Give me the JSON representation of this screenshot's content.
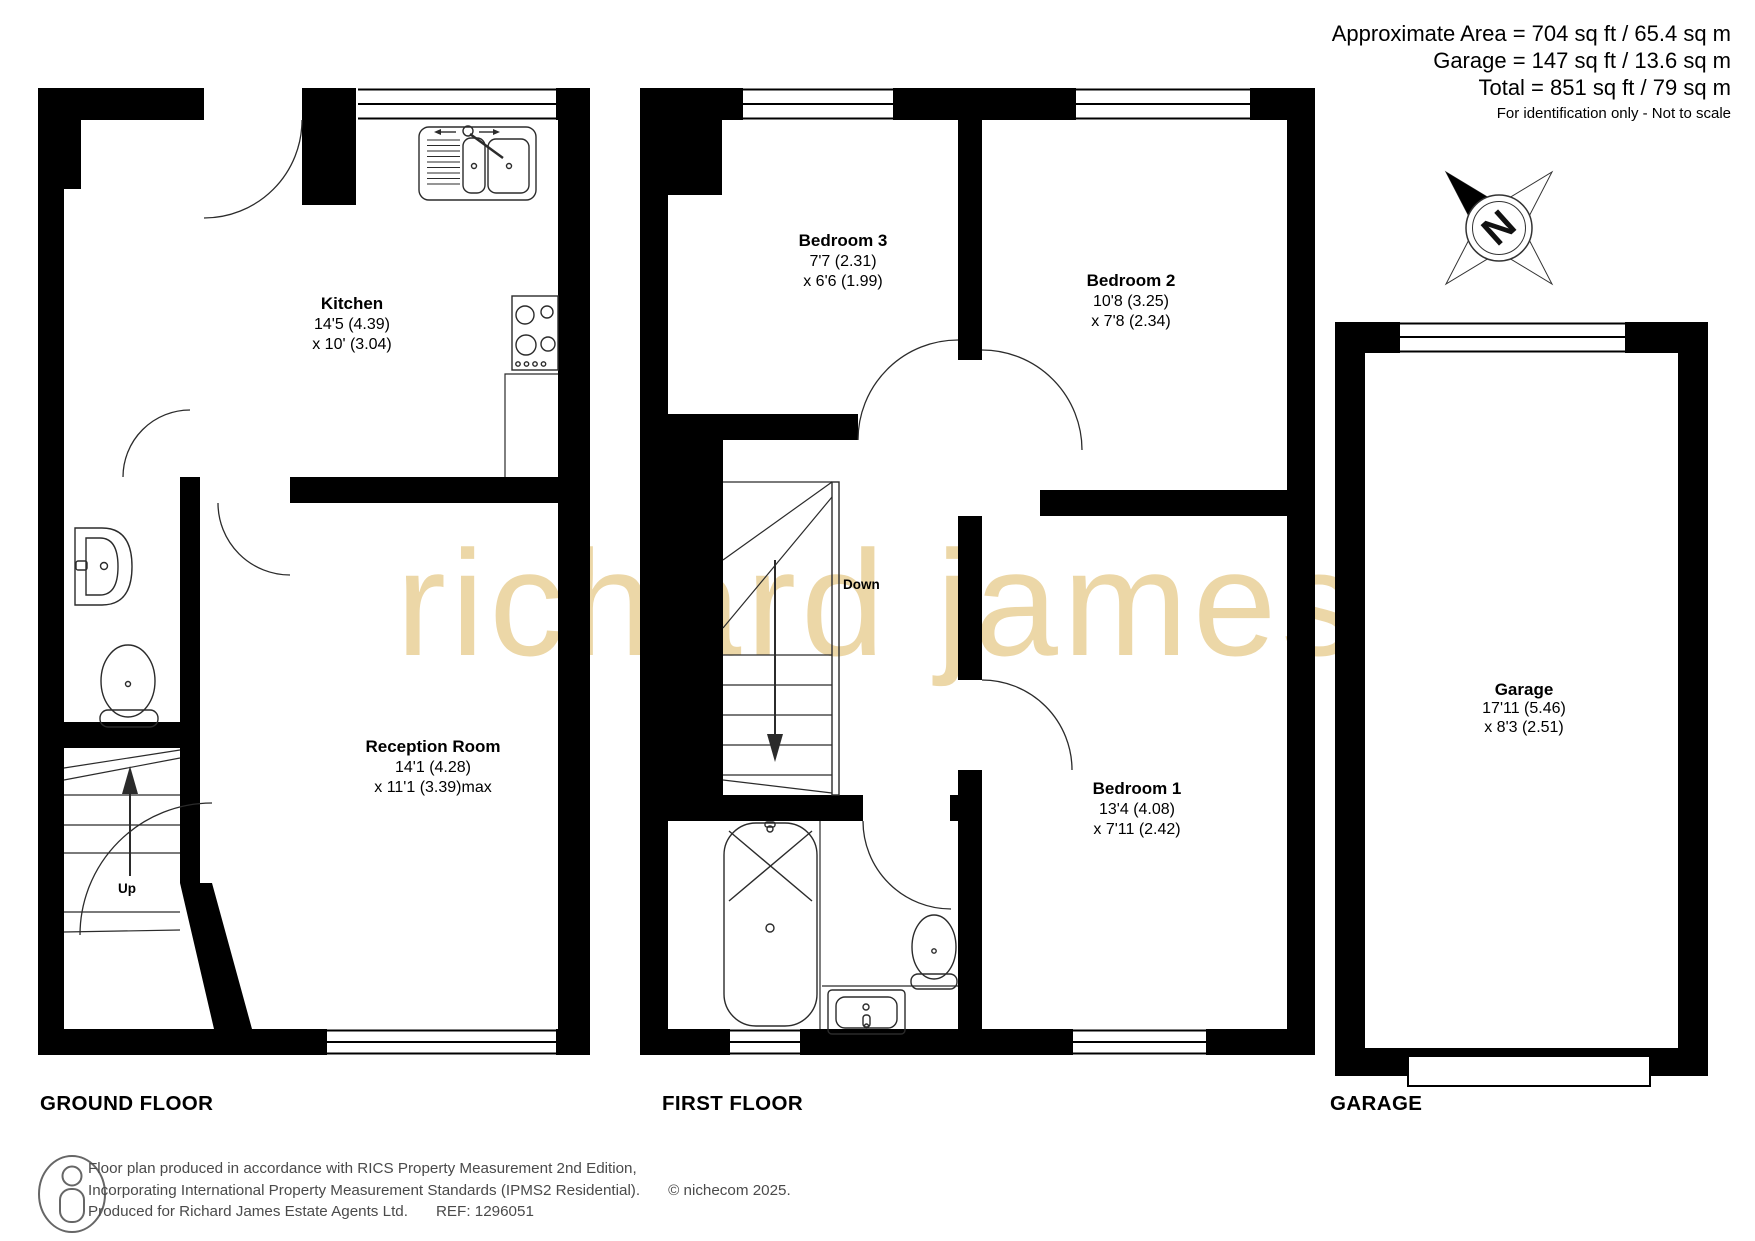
{
  "header": {
    "area_line1": "Approximate Area = 704 sq ft / 65.4 sq m",
    "area_line2": "Garage = 147 sq ft / 13.6 sq m",
    "area_line3": "Total = 851 sq ft / 79 sq m",
    "note": "For identification only - Not to scale"
  },
  "compass": {
    "north_label": "N"
  },
  "watermark": {
    "text": "richard james",
    "color": "#ecd7a7"
  },
  "floors": {
    "ground": {
      "label": "GROUND FLOOR",
      "rooms": {
        "kitchen": {
          "name": "Kitchen",
          "dim1": "14'5 (4.39)",
          "dim2": "x 10' (3.04)"
        },
        "reception": {
          "name": "Reception Room",
          "dim1": "14'1 (4.28)",
          "dim2": "x 11'1 (3.39)max"
        }
      },
      "stairs_label": "Up"
    },
    "first": {
      "label": "FIRST FLOOR",
      "rooms": {
        "bedroom3": {
          "name": "Bedroom 3",
          "dim1": "7'7 (2.31)",
          "dim2": "x 6'6 (1.99)"
        },
        "bedroom2": {
          "name": "Bedroom 2",
          "dim1": "10'8 (3.25)",
          "dim2": "x 7'8 (2.34)"
        },
        "bedroom1": {
          "name": "Bedroom 1",
          "dim1": "13'4 (4.08)",
          "dim2": "x 7'11 (2.42)"
        }
      },
      "stairs_label": "Down"
    },
    "garage": {
      "label": "GARAGE",
      "rooms": {
        "garage": {
          "name": "Garage",
          "dim1": "17'11 (5.46)",
          "dim2": "x 8'3 (2.51)"
        }
      }
    }
  },
  "footer": {
    "line1": "Floor plan produced in accordance with RICS Property Measurement 2nd Edition,",
    "line2": "Incorporating International Property Measurement Standards (IPMS2 Residential).",
    "copyright": "© nichecom 2025.",
    "line3": "Produced for Richard James Estate Agents Ltd.",
    "ref": "REF: 1296051"
  },
  "colors": {
    "wall": "#000000",
    "fixture_line": "#2b2b2b",
    "watermark": "#ecd7a7",
    "footer_text": "#4a4a4a"
  }
}
